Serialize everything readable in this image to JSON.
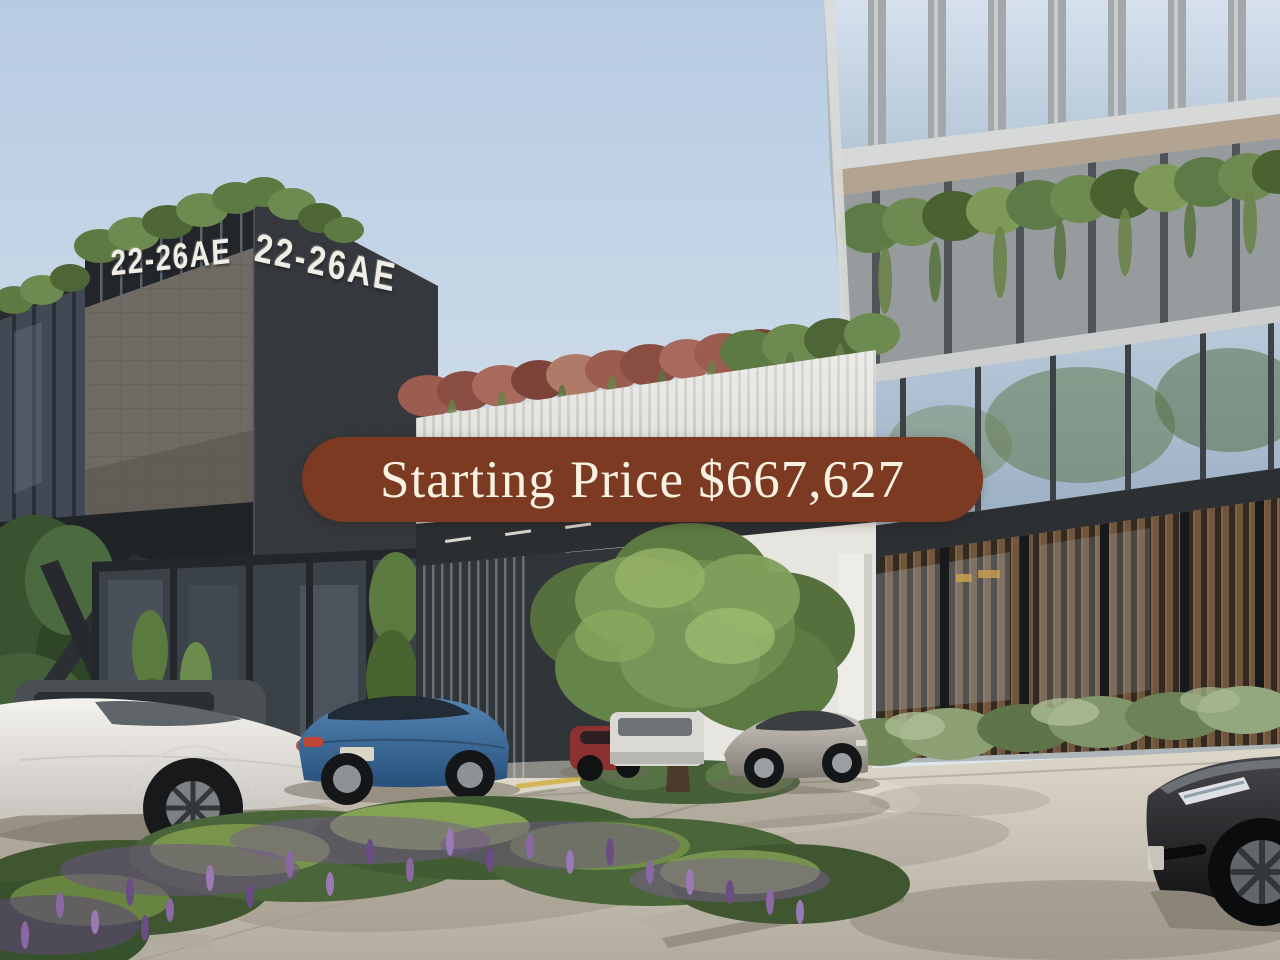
{
  "banner": {
    "label": "Starting Price $667,627",
    "bg_color": "#7B3A21",
    "text_color": "#F9F2E2"
  },
  "building_signs": {
    "left_face": "22-26AE",
    "front_face": "22-26AE",
    "color": "#EFEDE6"
  },
  "palette": {
    "sky_top": "#B7CBE2",
    "sky_bottom": "#E7ECF0",
    "dark_facade": "#35393D",
    "mesh_panel": "#6F6A63",
    "canopy_slats": "#DCDCD6",
    "glass_blue": "#C4D4E4",
    "timber_slats": "#7B5D3F",
    "spandrel": "#969B9E",
    "foliage_green": "#5D7A42",
    "foliage_red": "#9A5D50",
    "lavender": "#7B5F92",
    "pavement": "#C9C3B6",
    "shadow": "#948C7E"
  },
  "vehicles": [
    {
      "name": "dark-suv",
      "color": "#4A4F54"
    },
    {
      "name": "white-coupe",
      "color": "#E9E7E2"
    },
    {
      "name": "blue-sedan",
      "color": "#3C6E9F"
    },
    {
      "name": "red-car",
      "color": "#8D3030"
    },
    {
      "name": "white-van",
      "color": "#DAD9D3"
    },
    {
      "name": "silver-coupe",
      "color": "#B7B2AA"
    },
    {
      "name": "black-sedan",
      "color": "#232325"
    }
  ]
}
